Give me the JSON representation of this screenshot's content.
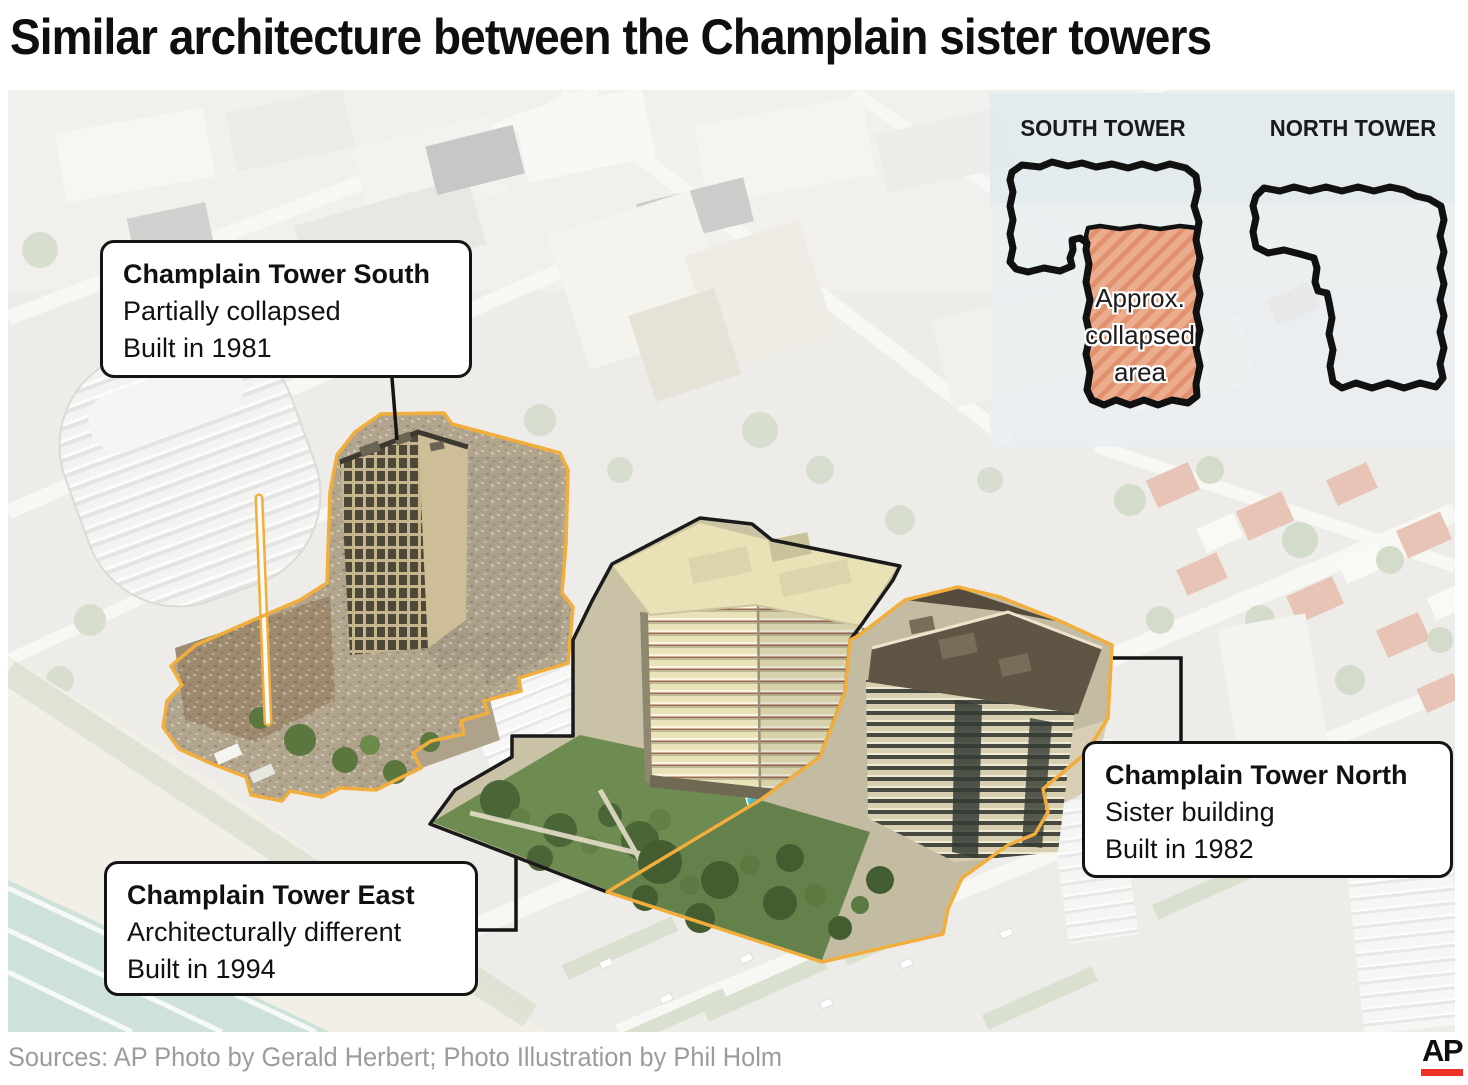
{
  "title": "Similar architecture between the Champlain sister towers",
  "callouts": {
    "south": {
      "name": "Champlain Tower South",
      "detail": "Partially collapsed",
      "built": "Built in 1981"
    },
    "east": {
      "name": "Champlain Tower East",
      "detail": "Architecturally different",
      "built": "Built in 1994"
    },
    "north": {
      "name": "Champlain Tower North",
      "detail": "Sister building",
      "built": "Built in 1982"
    }
  },
  "inset": {
    "south_label": "SOUTH TOWER",
    "north_label": "NORTH TOWER",
    "collapsed_area_label": "Approx. collapsed area"
  },
  "footer": {
    "source_line": "Sources: AP Photo by Gerald Herbert; Photo Illustration by Phil Holm",
    "ap_logo_text": "AP"
  },
  "colors": {
    "highlight-outline": "#F2AE3C",
    "east-outline": "#1A1A1A",
    "collapsed-area-fill": "#ECAC8E",
    "collapsed-area-stripe": "#E0926E",
    "ap-red": "#EE3124",
    "source-text": "#9C9C9C"
  }
}
